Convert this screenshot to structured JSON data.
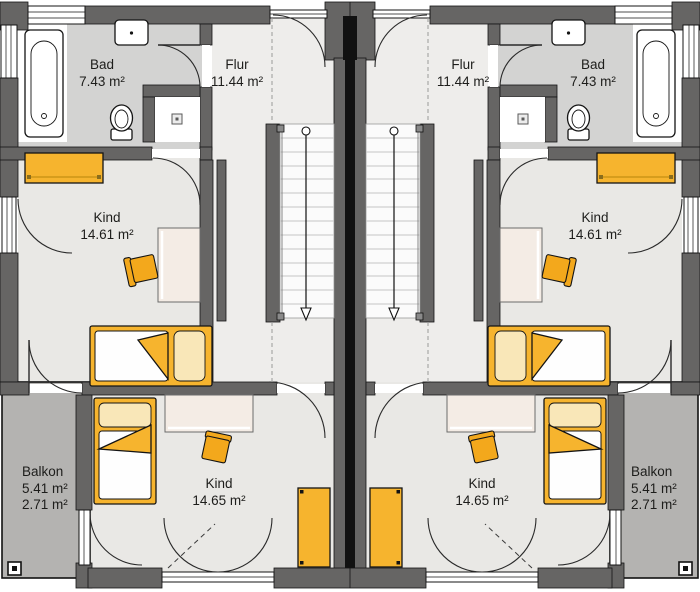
{
  "rooms": [
    {
      "id": "bad-left",
      "name": "Bad",
      "area": "7.43 m²"
    },
    {
      "id": "flur-left",
      "name": "Flur",
      "area": "11.44 m²"
    },
    {
      "id": "flur-right",
      "name": "Flur",
      "area": "11.44 m²"
    },
    {
      "id": "bad-right",
      "name": "Bad",
      "area": "7.43 m²"
    },
    {
      "id": "kind-upper-left",
      "name": "Kind",
      "area": "14.61 m²"
    },
    {
      "id": "kind-upper-right",
      "name": "Kind",
      "area": "14.61 m²"
    },
    {
      "id": "kind-lower-left",
      "name": "Kind",
      "area": "14.65 m²"
    },
    {
      "id": "kind-lower-right",
      "name": "Kind",
      "area": "14.65 m²"
    },
    {
      "id": "balkon-left",
      "name": "Balkon",
      "area": "5.41 m²",
      "area2": "2.71 m²"
    },
    {
      "id": "balkon-right",
      "name": "Balkon",
      "area": "5.41 m²",
      "area2": "2.71 m²"
    }
  ],
  "colors": {
    "wall": "#666564",
    "floor_bad": "#d3d3d2",
    "floor_room": "#e9e8e5",
    "floor_flur": "#eeedeb",
    "floor_balcony": "#b4b3b1",
    "furniture": "#f6b42e",
    "chair": "#f3a81c",
    "desk": "#f4ece5",
    "pillow": "#f9e7b8"
  },
  "fixtures": [
    "bathtub",
    "sink",
    "toilet",
    "shower-tray",
    "stairs",
    "stairs-direction-arrow",
    "bed",
    "desk",
    "chair",
    "wardrobe",
    "sideboard",
    "balcony-drain",
    "door-swing",
    "window"
  ]
}
